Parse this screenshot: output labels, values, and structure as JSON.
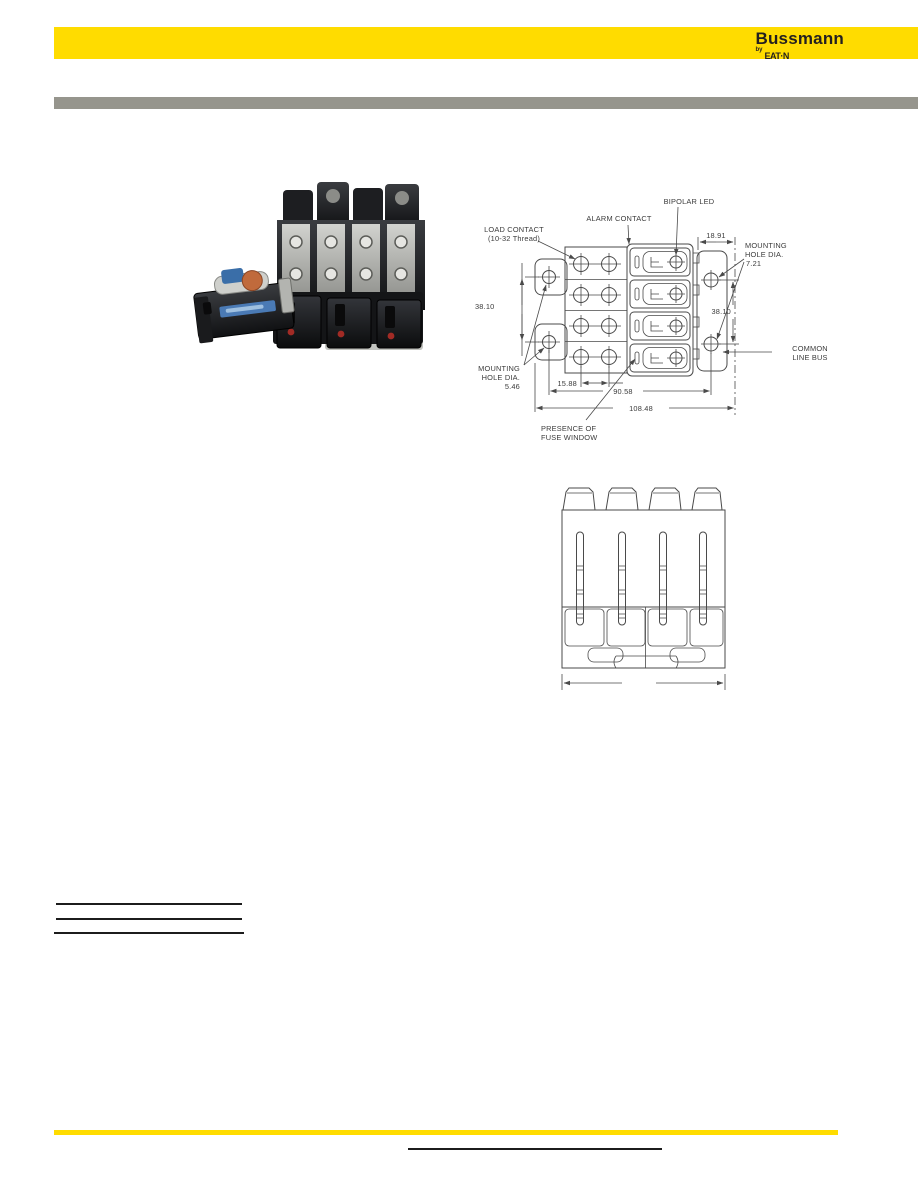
{
  "header": {
    "brand": "Bussmann",
    "byline_prefix": "by",
    "byline_logo": "EAT·N"
  },
  "colors": {
    "brand_yellow": "#FFDC00",
    "bar_gray": "#96958D",
    "rule_black": "#1C1C1C"
  },
  "dimension_drawing": {
    "labels": {
      "bipolar_led": "BIPOLAR LED",
      "alarm_contact": "ALARM CONTACT",
      "load_contact_line1": "LOAD CONTACT",
      "load_contact_line2": "(10-32 Thread)",
      "mounting_right_line1": "MOUNTING",
      "mounting_right_line2": "HOLE DIA.",
      "mounting_right_value": "7.21",
      "mounting_left_line1": "MOUNTING",
      "mounting_left_line2": "HOLE DIA.",
      "mounting_left_value": "5.46",
      "common_bus_line1": "COMMON",
      "common_bus_line2": "LINE BUS",
      "presence_line1": "PRESENCE OF",
      "presence_line2": "FUSE WINDOW"
    },
    "dimensions": {
      "top_right": "18.91",
      "left_vertical": "38.10",
      "right_vertical": "38.10",
      "contact_spacing": "15.88",
      "hole_span": "90.58",
      "overall_width": "108.48"
    }
  }
}
